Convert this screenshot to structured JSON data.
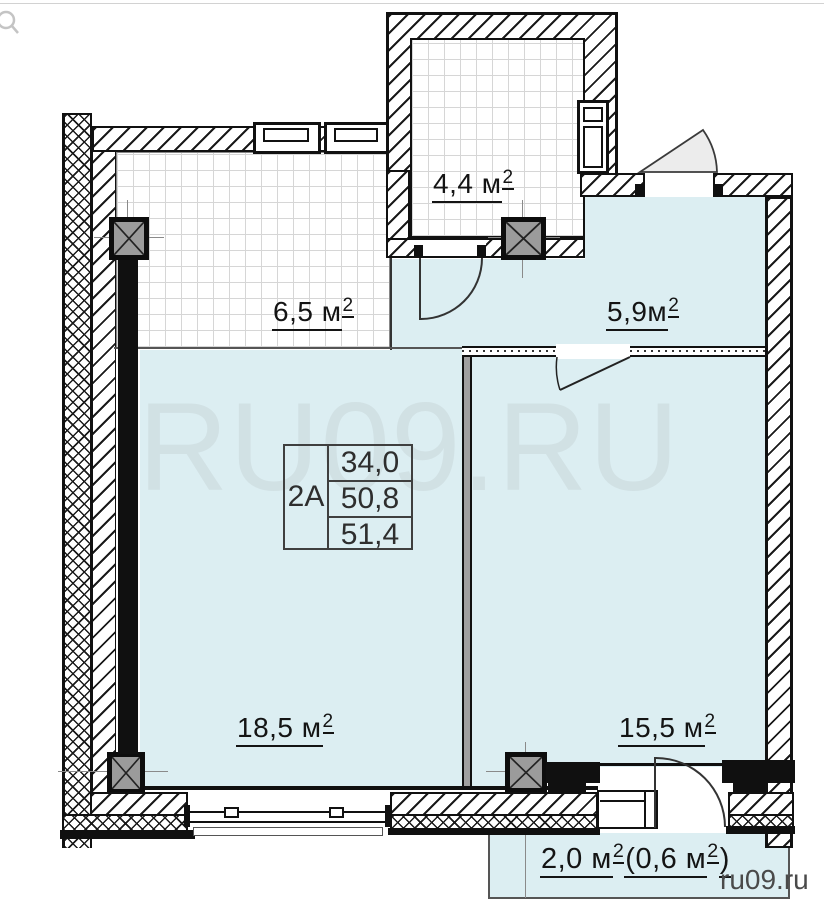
{
  "branding": {
    "watermark": "RU09.RU",
    "site": "ru09.ru"
  },
  "icons": {
    "top_left_cursor": "magnifier"
  },
  "apartment": {
    "unit": "2А",
    "areas": [
      "34,0",
      "50,8",
      "51,4"
    ]
  },
  "rooms": {
    "balcony_top": {
      "label": "4,4 м",
      "sup": "2"
    },
    "balcony_left": {
      "label": "6,5 м",
      "sup": "2"
    },
    "hall": {
      "label": "5,9м",
      "sup": "2"
    },
    "living": {
      "label": "18,5 м",
      "sup": "2"
    },
    "bedroom": {
      "label": "15,5 м",
      "sup": "2"
    },
    "balcony_bottom": {
      "p1": "2,0 м",
      "s1": "2",
      "p2": " (0,6 м",
      "s2": "2",
      "p3": ")"
    }
  },
  "colors": {
    "room_fill": "#dceef2",
    "wall": "#111111",
    "column_fill": "#9b9b9b",
    "watermark_text": "rgba(190,200,204,0.35)",
    "url_text": "#4a4a4a"
  }
}
